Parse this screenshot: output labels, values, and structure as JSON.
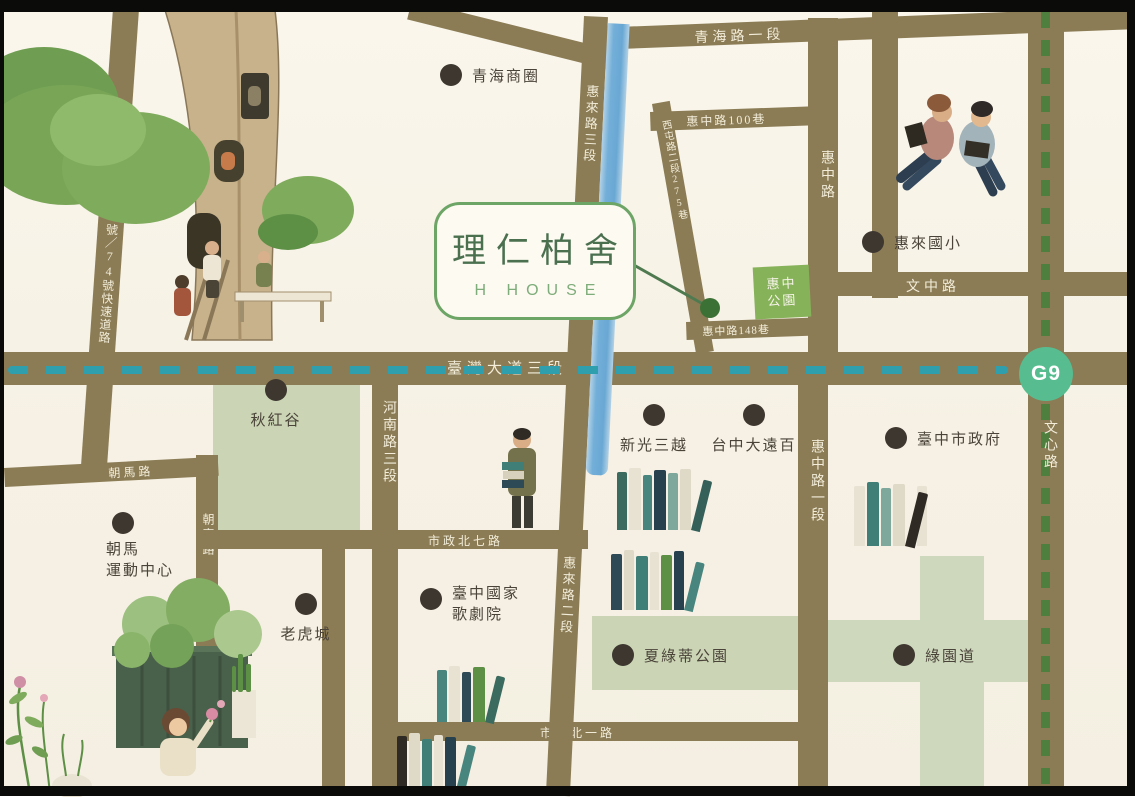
{
  "callout": {
    "name_zh": "理仁柏舍",
    "name_en": "H HOUSE"
  },
  "station": {
    "label": "G9"
  },
  "roads": {
    "qinghai": "青海路一段",
    "huizhong_ln100": "惠中路100巷",
    "xitun_lane": "西屯路二段275巷",
    "huizhong": "惠中路",
    "huizhong_sec1": "惠中路一段",
    "wenzhong": "文中路",
    "wenxin": "文心路",
    "huilai_sec3": "惠來路三段",
    "huilai_sec2": "惠來路二段",
    "huizhong_ln148": "惠中路148巷",
    "taiwan_blvd": "臺灣大道三段",
    "henan": "河南路三段",
    "chaoma": "朝馬路",
    "chaofu": "朝富路",
    "shizheng_n7": "市政北七路",
    "shizheng_n1": "市政北一路",
    "highway": "國道一號／74號快速道路"
  },
  "pois": {
    "qinghai_district": "青海商圈",
    "huilai_school": "惠來國小",
    "city_hall": "臺中市政府",
    "shinkong": "新光三越",
    "top_city": "台中大遠百",
    "qiuhonggu": "秋紅谷",
    "chaoma_sports_1": "朝馬",
    "chaoma_sports_2": "運動中心",
    "tiger_city": "老虎城",
    "opera_1": "臺中國家",
    "opera_2": "歌劇院",
    "charlotte_park": "夏綠蒂公園",
    "greenway": "綠園道",
    "huizhong_park_1": "惠中",
    "huizhong_park_2": "公園"
  },
  "colors": {
    "road": "#8b7c55",
    "park_green": "#cbd5b5",
    "park_box_green": "#86b259",
    "river_blue": "#72aed8",
    "brt_teal": "#2f9fae",
    "mrt_green": "#4e7f3f",
    "station_green": "#57bd90",
    "callout_border": "#6da566",
    "callout_text": "#4a7050",
    "poi_dot": "#3d3730"
  }
}
